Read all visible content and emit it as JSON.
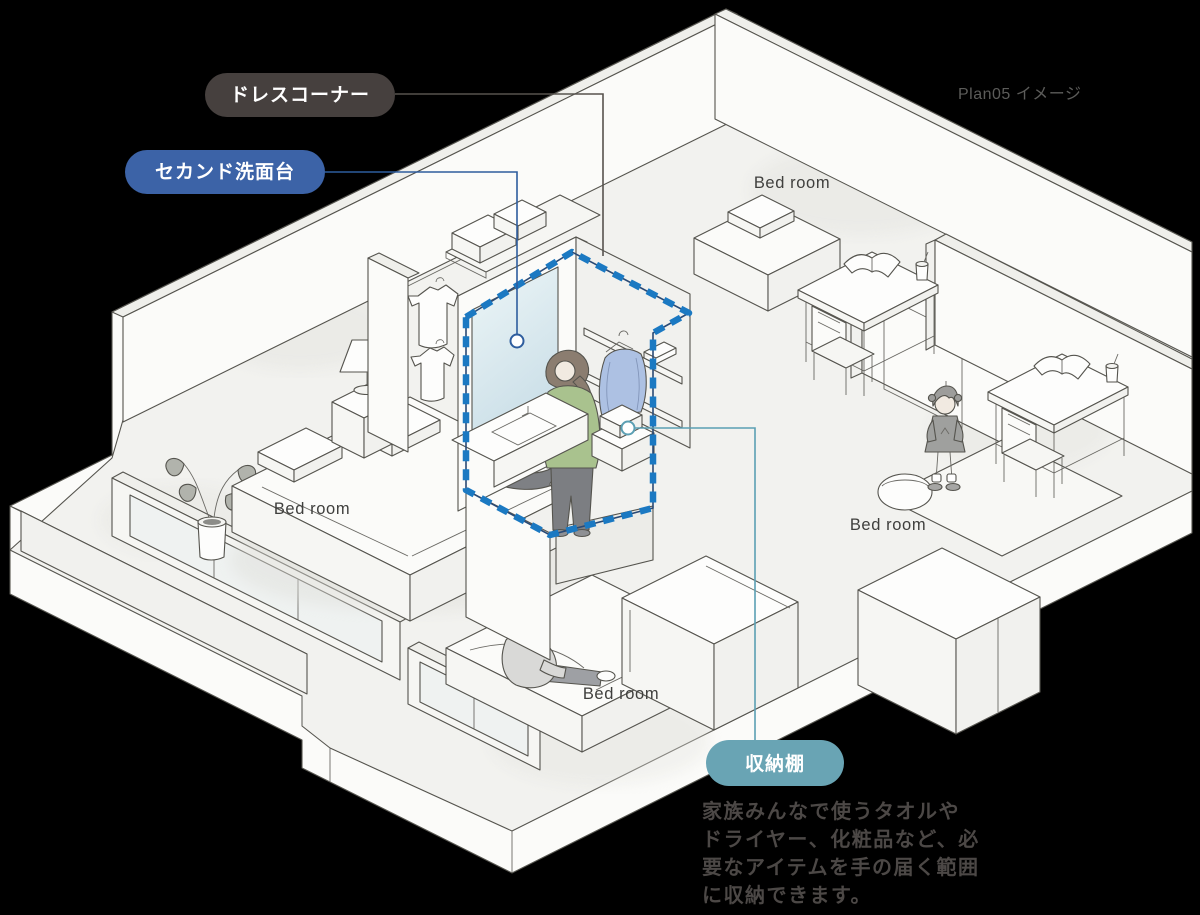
{
  "plan_label": "Plan05 イメージ",
  "callouts": {
    "dress_corner": {
      "label": "ドレスコーナー",
      "bg": "#46403E",
      "line": "#57534E"
    },
    "second_vanity": {
      "label": "セカンド洗面台",
      "bg": "#3C63A7",
      "line": "#2E5D9E"
    },
    "storage_shelf": {
      "label": "収納棚",
      "bg": "#69A4B4",
      "line": "#5B9FB3"
    }
  },
  "rooms": {
    "bedroom_labels": [
      "Bed room",
      "Bed room",
      "Bed room",
      "Bed room"
    ]
  },
  "description": {
    "lines": [
      "家族みんなで使うタオルや",
      "ドライヤー、化粧品など、必",
      "要なアイテムを手の届く範囲",
      "に収納できます。"
    ]
  },
  "highlight": {
    "dash_color": "#1B79C2",
    "dash_underlay": "#2A4A75"
  },
  "canvas": {
    "background": "#000000"
  }
}
